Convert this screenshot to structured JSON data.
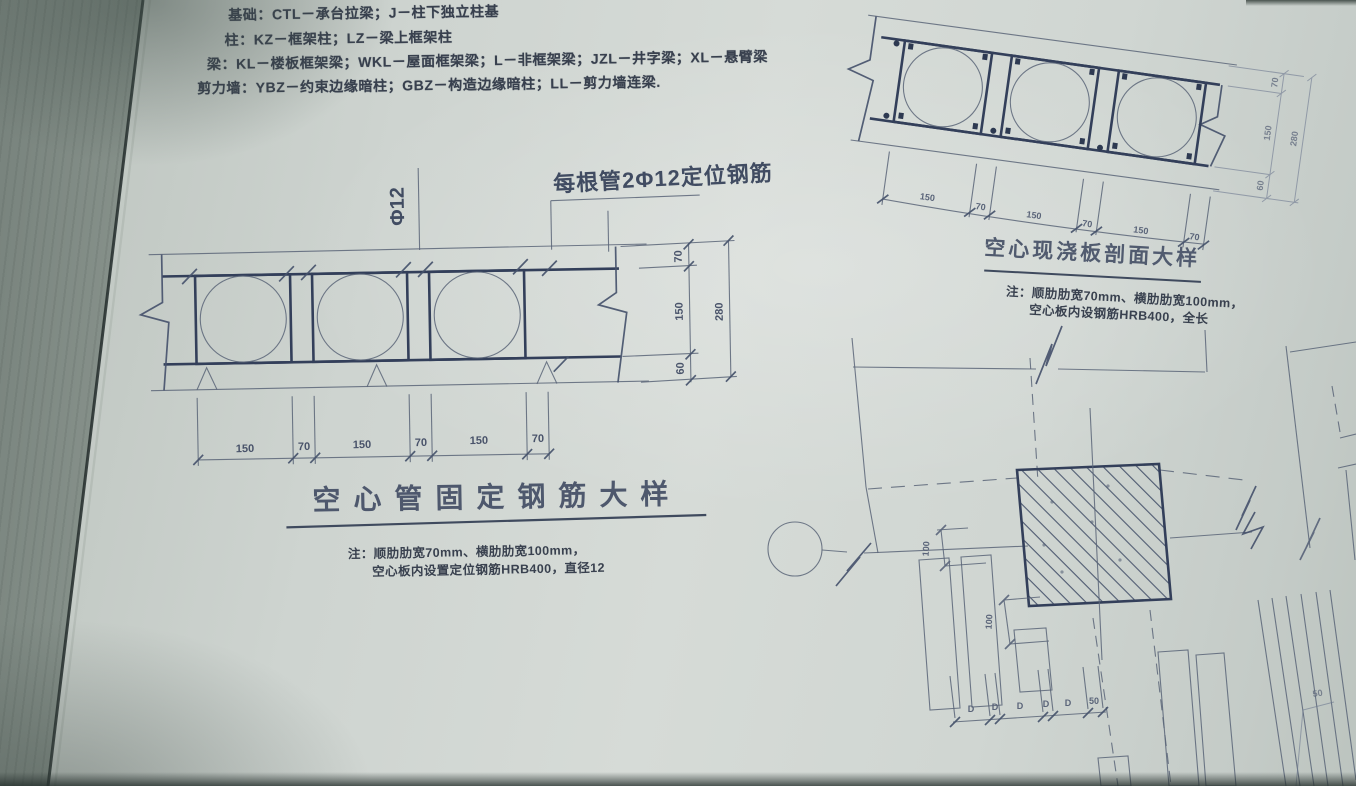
{
  "legend": {
    "lines": [
      "基础：CTL－承台拉梁；J－柱下独立柱基",
      "柱：KZ－框架柱；LZ－梁上框架柱",
      "梁：KL－楼板框架梁；WKL－屋面框架梁；L－非框架梁；JZL－井字梁；XL－悬臂梁",
      "剪力墙：YBZ－约束边缘暗柱；GBZ－构造边缘暗柱；LL－剪力墙连梁."
    ]
  },
  "left_detail": {
    "phi_label": "Φ12",
    "leader_label": "每根管2Φ12定位钢筋",
    "title": "空心管固定钢筋大样",
    "note_line1": "注：顺肋肋宽70mm、横肋肋宽100mm，",
    "note_line2": "空心板内设置定位钢筋HRB400，直径12",
    "dims_bottom": [
      "150",
      "70",
      "150",
      "70",
      "150",
      "70"
    ],
    "dims_right": [
      "70",
      "150",
      "60"
    ],
    "dim_total": "280"
  },
  "section_detail": {
    "title": "空心现浇板剖面大样",
    "note_line1": "注：顺肋肋宽70mm、横肋肋宽100mm，",
    "note_line2": "空心板内设钢筋HRB400，全长",
    "dims_bottom": [
      "150",
      "70",
      "150",
      "70",
      "150",
      "70"
    ],
    "dims_right": [
      "70",
      "150",
      "60"
    ],
    "dim_total": "280"
  },
  "plan_detail": {
    "dim_a": "100",
    "dim_b": "100",
    "dims_bottom": [
      "D",
      "D",
      "D",
      "D",
      "D",
      "50"
    ],
    "edge_note": "50"
  },
  "colors": {
    "paper": "#d0d6d2",
    "ink": "#3f4a60",
    "ink_dark": "#2d3951",
    "book_edge": "#27302f"
  }
}
